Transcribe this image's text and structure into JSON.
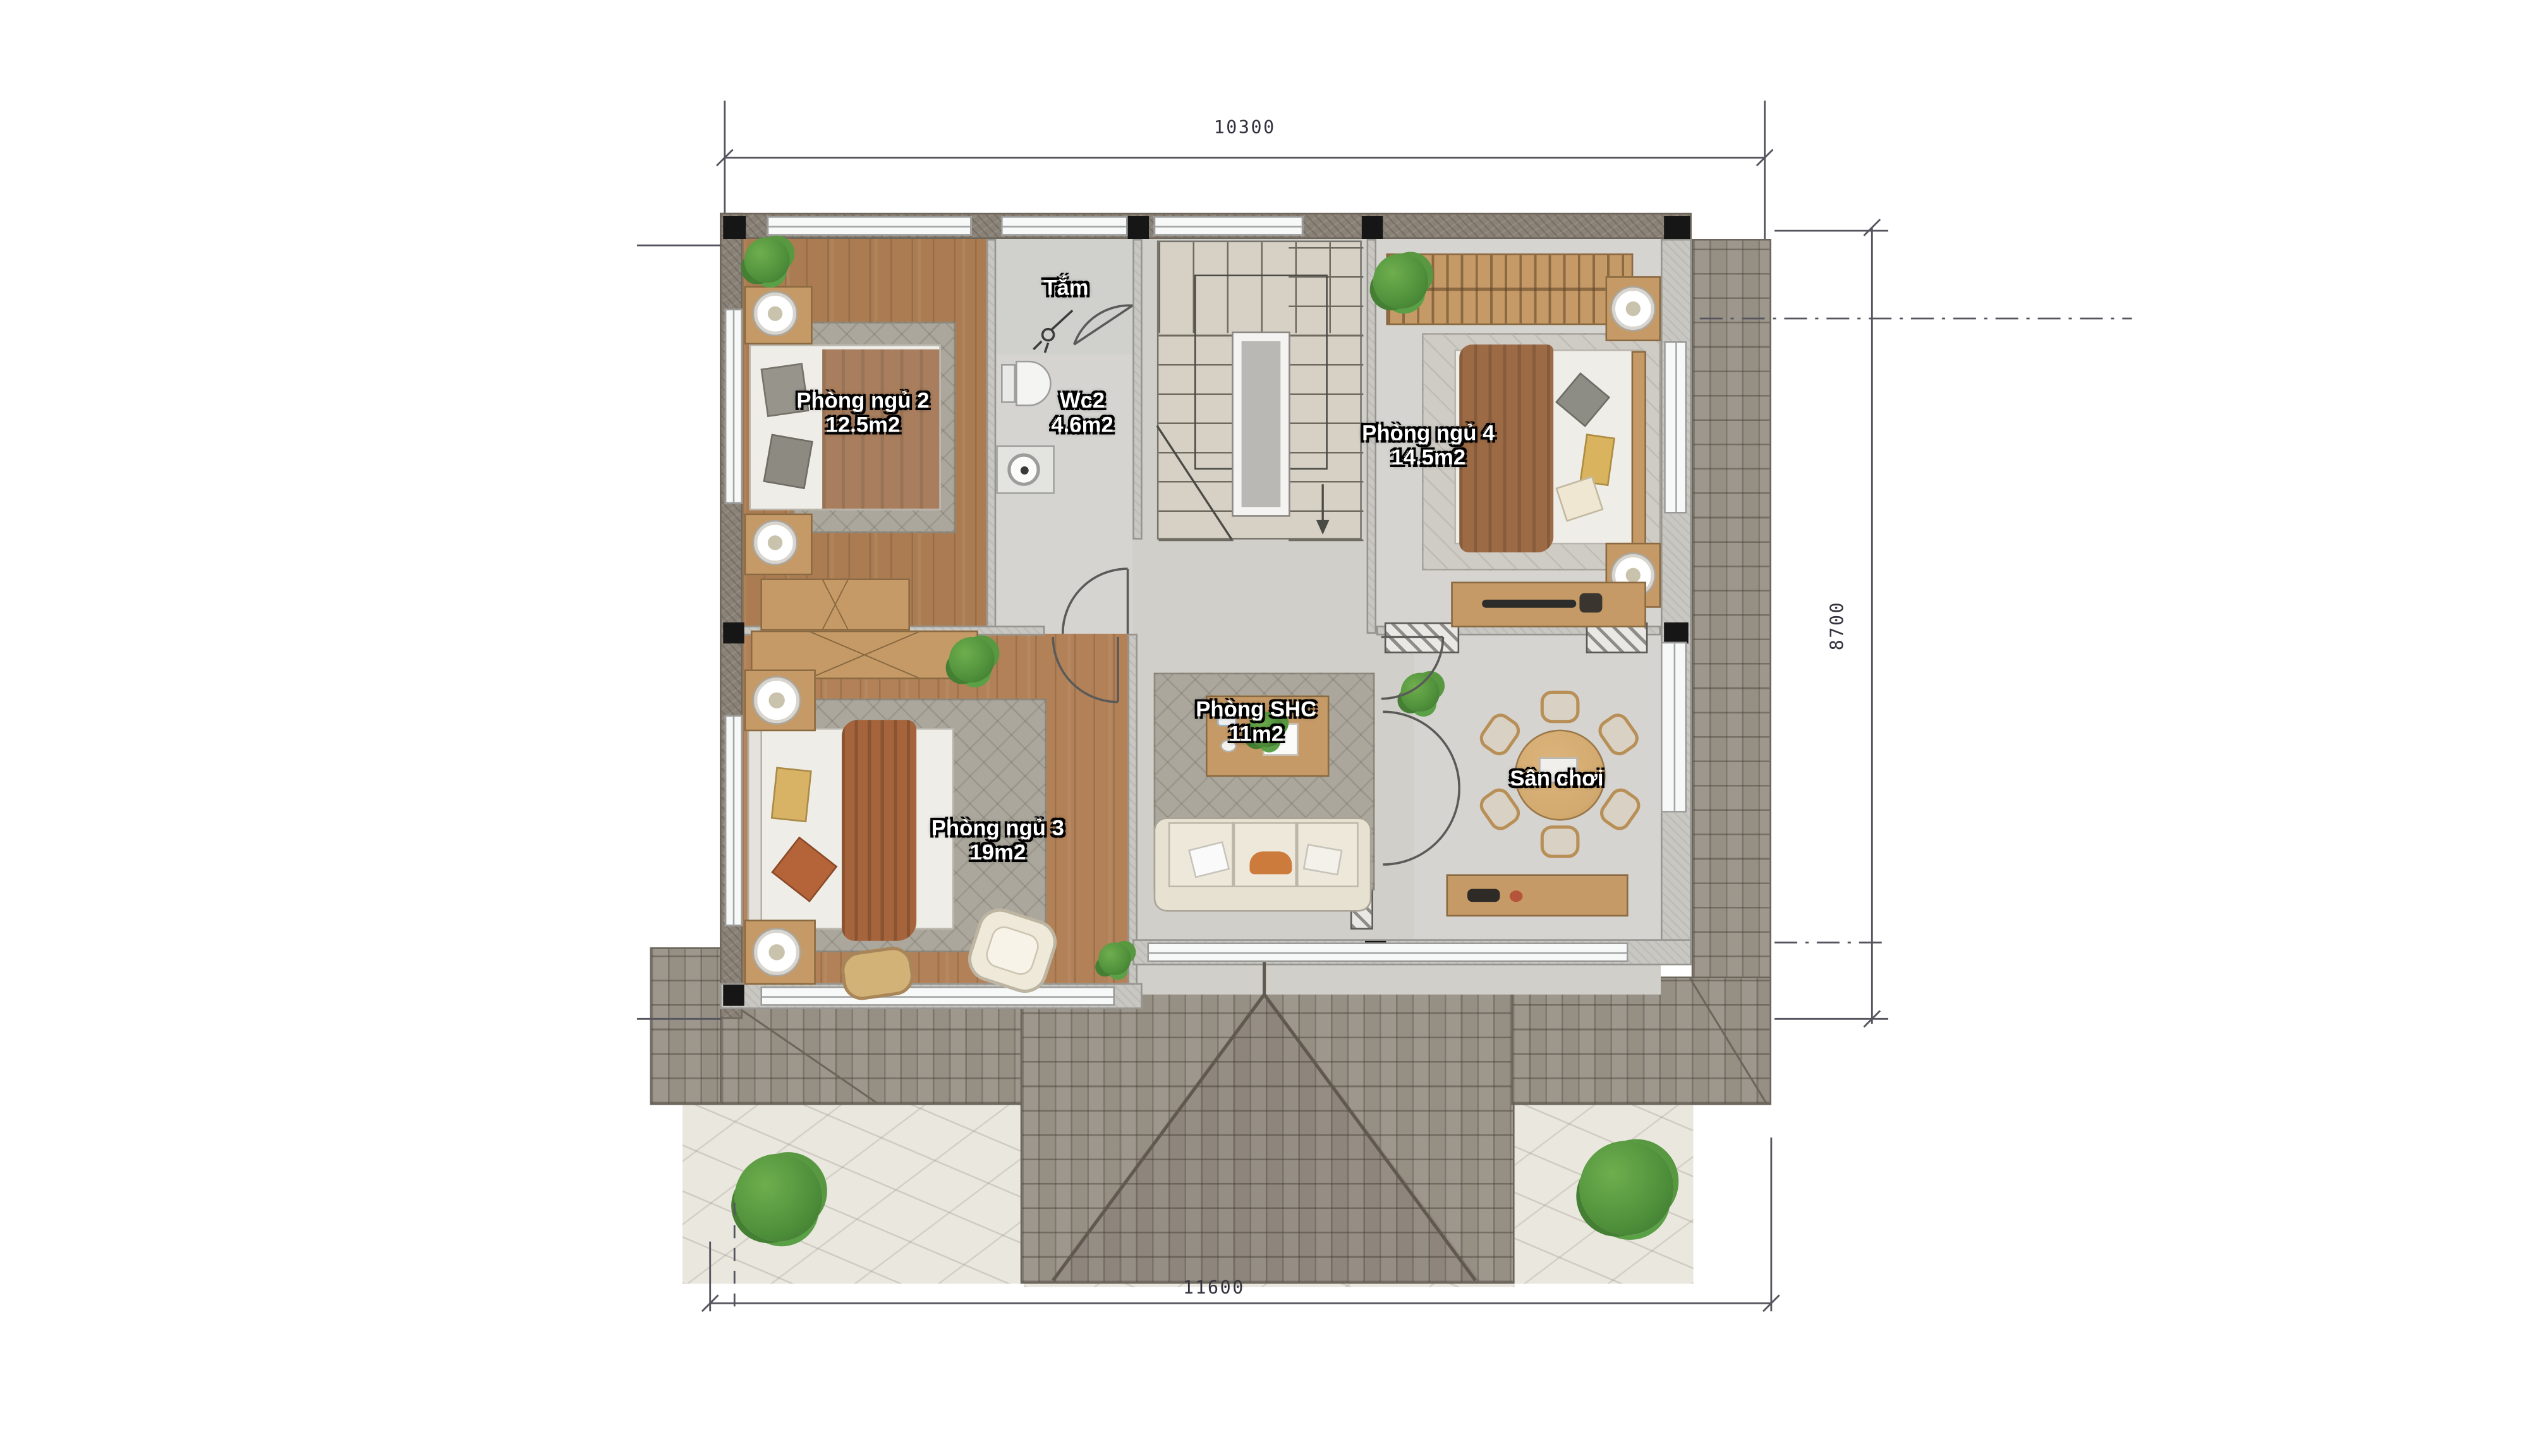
{
  "plan_title": "Second floor plan",
  "rooms": [
    {
      "name": "Phòng ngủ 2",
      "area": "12.5m2"
    },
    {
      "name": "Tắm",
      "area": ""
    },
    {
      "name": "Wc2",
      "area": "4.6m2"
    },
    {
      "name": "Phòng ngủ 4",
      "area": "14.5m2"
    },
    {
      "name": "Phòng SHC",
      "area": "11m2"
    },
    {
      "name": "Sân chơi",
      "area": ""
    },
    {
      "name": "Phòng ngủ 3",
      "area": "19m2"
    }
  ],
  "dimensions": {
    "top": "10300",
    "right": "8700",
    "bottom": "11600"
  },
  "icons": [
    "tree-icon",
    "plant-icon",
    "bed-icon",
    "sofa-icon",
    "round-table-icon",
    "toilet-icon",
    "sink-icon",
    "shower-icon",
    "stairs-up-arrow-icon",
    "lamp-icon"
  ],
  "colors": {
    "wood_floor": "#ab7c52",
    "wood_floor_light": "#b28157",
    "gray_floor": "#d5d4d0",
    "hall_floor": "#d0cfca",
    "wall": "#c9c7c2",
    "eave": "#8a8277",
    "roof_tile": "#968f84",
    "patio": "#eae7df",
    "rug": "#aba79c",
    "sofa": "#e7e1d2",
    "wood_furniture": "#c69a66",
    "blanket_brown": "#9c6b46",
    "blanket_orange": "#a5643c",
    "tree": "#4e8f3a",
    "label_text": "#ffffff",
    "dim_text": "#33333f"
  }
}
